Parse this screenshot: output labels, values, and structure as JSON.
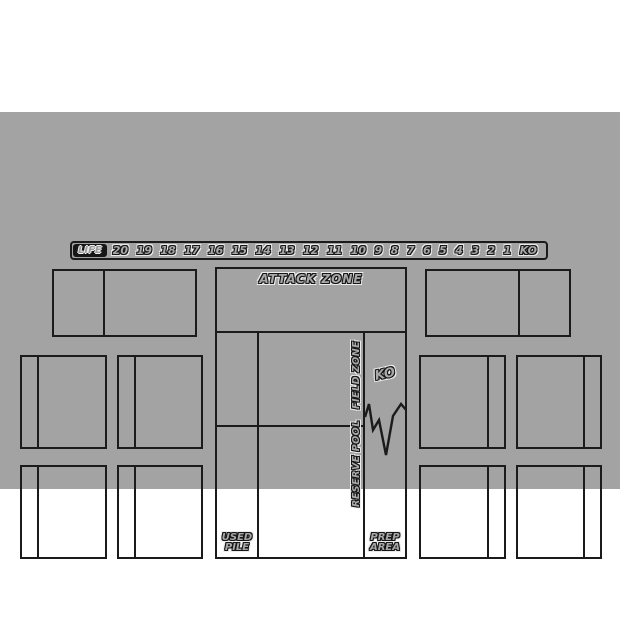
{
  "colors": {
    "page_bg": "#ffffff",
    "mat_bg": "#a3a3a3",
    "line": "#1b1b1b",
    "label_fill": "#a8a8a8",
    "label_outline_dark": "#161616",
    "label_outline_light": "#ececec",
    "life_badge_bg": "#161616"
  },
  "life_track": {
    "label": "LIFE",
    "values": [
      "20",
      "19",
      "18",
      "17",
      "16",
      "15",
      "14",
      "13",
      "12",
      "11",
      "10",
      "9",
      "8",
      "7",
      "6",
      "5",
      "4",
      "3",
      "2",
      "1",
      "KO"
    ]
  },
  "zones": {
    "attack": "ATTACK ZONE",
    "field": "FIELD ZONE",
    "reserve": "RESERVE POOL",
    "ko": "KO",
    "used_pile": {
      "line1": "USED",
      "line2": "PILE"
    },
    "prep_area": {
      "line1": "PREP",
      "line2": "AREA"
    }
  }
}
